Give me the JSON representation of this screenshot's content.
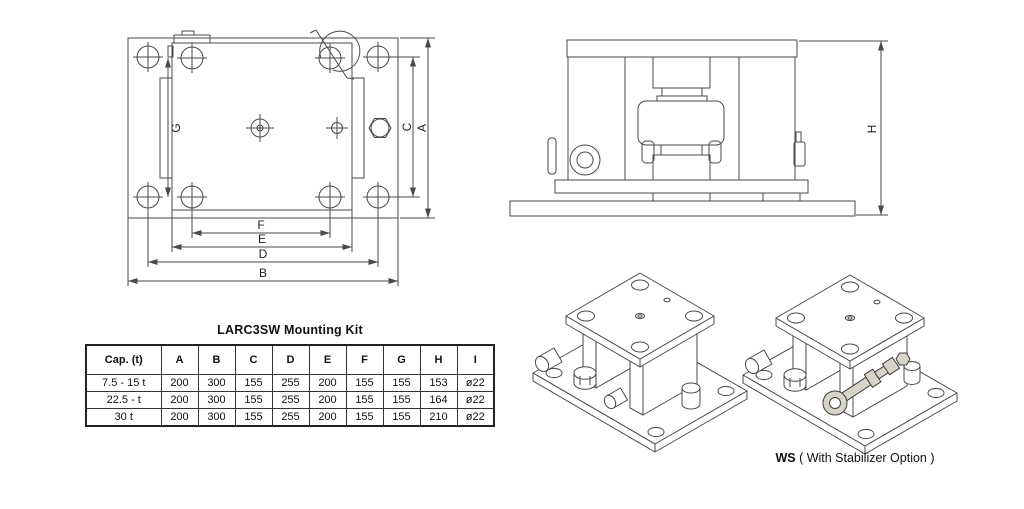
{
  "top_view": {
    "labels": {
      "A": "A",
      "B": "B",
      "C": "C",
      "D": "D",
      "E": "E",
      "F": "F",
      "G": "G"
    }
  },
  "side_view": {
    "labels": {
      "H": "H"
    }
  },
  "table": {
    "title": "LARC3SW Mounting Kit",
    "headers": [
      "Cap. (t)",
      "A",
      "B",
      "C",
      "D",
      "E",
      "F",
      "G",
      "H",
      "I"
    ],
    "rows": [
      [
        "7.5 - 15 t",
        "200",
        "300",
        "155",
        "255",
        "200",
        "155",
        "155",
        "153",
        "ø22"
      ],
      [
        "22.5 - t",
        "200",
        "300",
        "155",
        "255",
        "200",
        "155",
        "155",
        "164",
        "ø22"
      ],
      [
        "30 t",
        "200",
        "300",
        "155",
        "255",
        "200",
        "155",
        "155",
        "210",
        "ø22"
      ]
    ]
  },
  "ws_caption": {
    "bold": "WS",
    "rest": " ( With Stabilizer Option )"
  },
  "colors": {
    "line": "#4a4a4a",
    "stabilizer_fill": "#d7d3c9",
    "text": "#111111"
  }
}
